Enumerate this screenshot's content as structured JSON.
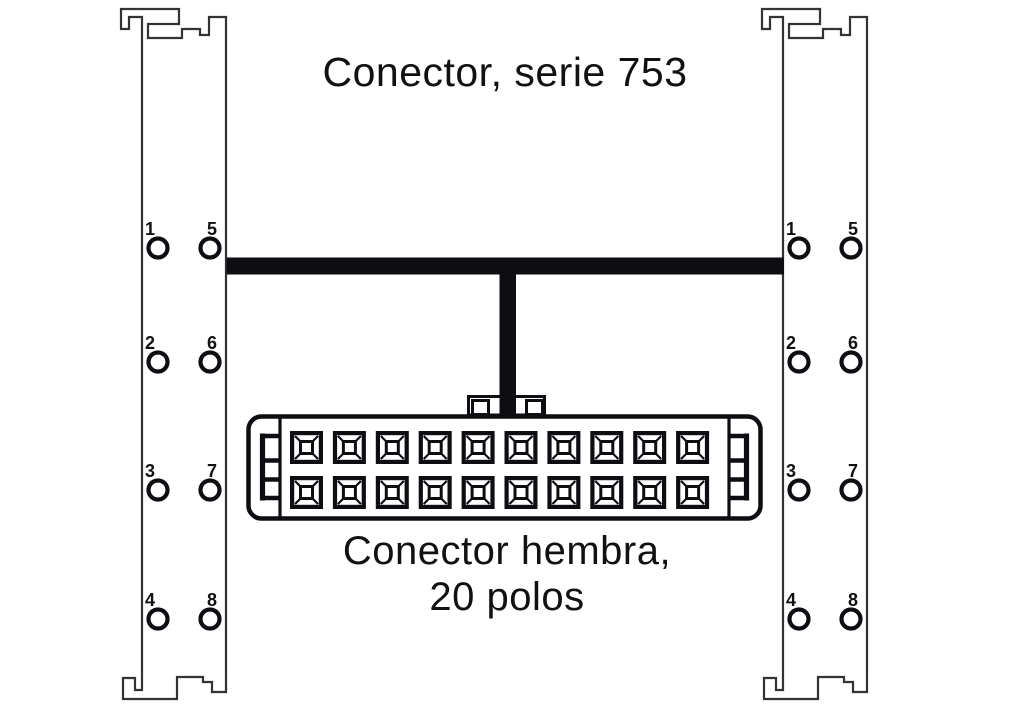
{
  "title": "Conector, serie 753",
  "connector": {
    "label_line1": "Conector hembra,",
    "label_line2": "20 polos",
    "poles": 20,
    "rows": 2,
    "columns": 10
  },
  "rails": {
    "left": {
      "pin_labels": [
        "1",
        "2",
        "3",
        "4",
        "5",
        "6",
        "7",
        "8"
      ]
    },
    "right": {
      "pin_labels": [
        "1",
        "2",
        "3",
        "4",
        "5",
        "6",
        "7",
        "8"
      ]
    }
  },
  "colors": {
    "line": "#0d0d12",
    "rail_line": "#333333",
    "background": "#ffffff"
  }
}
